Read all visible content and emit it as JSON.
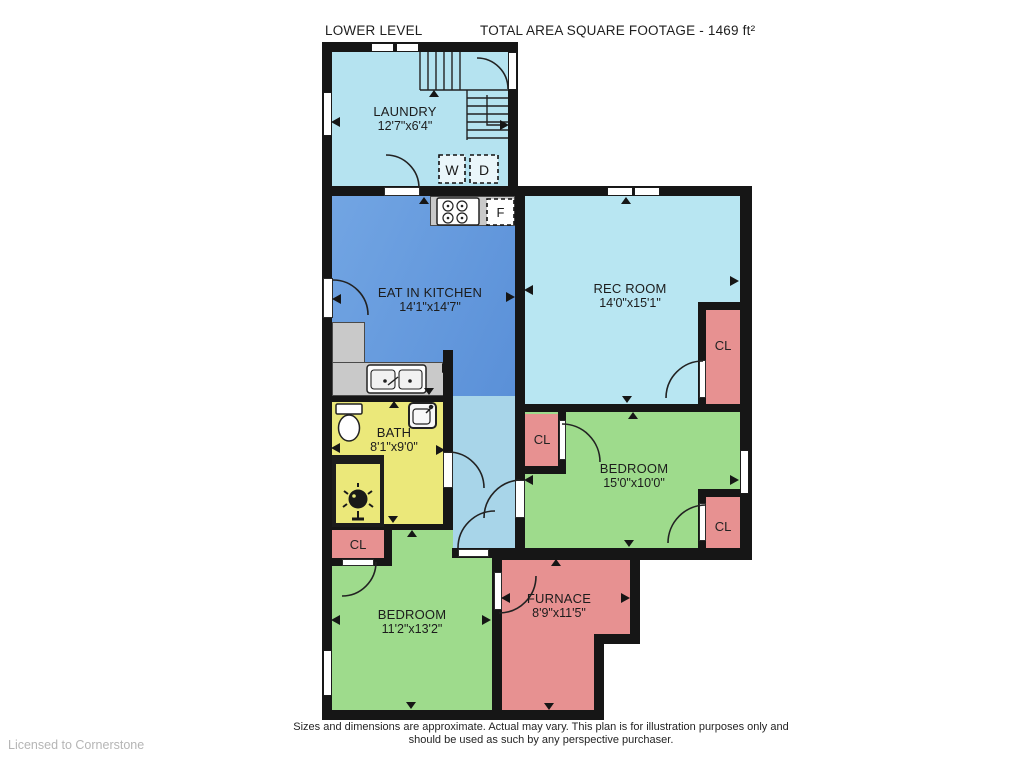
{
  "header": {
    "plan_label": "LOWER LEVEL",
    "total_area": "TOTAL AREA SQUARE FOOTAGE - 1469 ft²"
  },
  "rooms": {
    "laundry": {
      "name": "LAUNDRY",
      "dims": "12'7\"x6'4\""
    },
    "kitchen": {
      "name": "EAT IN KITCHEN",
      "dims": "14'1\"x14'7\""
    },
    "rec_room": {
      "name": "REC ROOM",
      "dims": "14'0\"x15'1\""
    },
    "bath": {
      "name": "BATH",
      "dims": "8'1\"x9'0\""
    },
    "bedroom_right": {
      "name": "BEDROOM",
      "dims": "15'0\"x10'0\""
    },
    "bedroom_left": {
      "name": "BEDROOM",
      "dims": "11'2\"x13'2\""
    },
    "furnace": {
      "name": "FURNACE",
      "dims": "8'9\"x11'5\""
    }
  },
  "labels": {
    "closet": "CL",
    "washer": "W",
    "dryer": "D",
    "fridge": "F"
  },
  "footer": {
    "disclaimer_line1": "Sizes and dimensions are approximate. Actual may vary. This plan is for illustration purposes only and",
    "disclaimer_line2": "should be used as such by any perspective purchaser.",
    "license": "Licensed to Cornerstone"
  },
  "colors": {
    "wall": "#161616",
    "laundry": "#b5e3f0",
    "kitchen": "#6299dd",
    "rec_room": "#b8e6f2",
    "hallway": "#a8d5e9",
    "bath": "#ebe87a",
    "bedroom": "#9edb8c",
    "closet_furnace": "#e79191",
    "counter": "#c9c9c9"
  }
}
